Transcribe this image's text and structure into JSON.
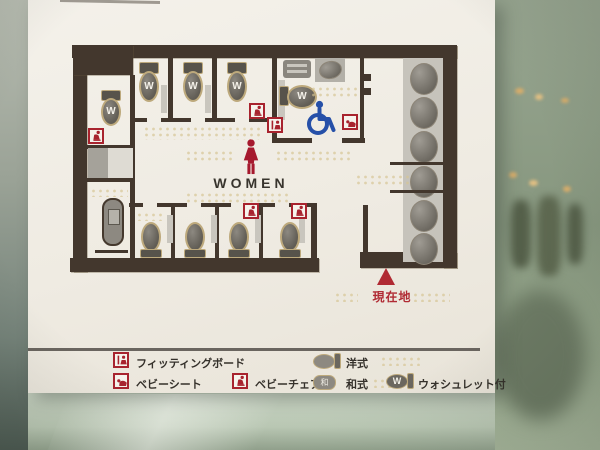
{
  "sign": {
    "type": "restroom-floor-plan",
    "title": "WOMEN",
    "current_location_label": "現在地",
    "washlet_letter": "W",
    "squat_mark": "和",
    "legend": {
      "items": [
        {
          "icon": "fitting-board-icon",
          "label": "フィッティングボード"
        },
        {
          "icon": "baby-sheet-icon",
          "label": "ベビーシート"
        },
        {
          "icon": "baby-chair-icon",
          "label": "ベビーチェア"
        },
        {
          "icon": "western-toilet-icon",
          "label": "洋式"
        },
        {
          "icon": "squat-toilet-icon",
          "label": "和式"
        },
        {
          "icon": "washlet-toilet-icon",
          "label": "ウォシュレット付"
        }
      ]
    },
    "fixtures": {
      "washlet_western_toilets": 5,
      "plain_western_toilets": 4,
      "squat_toilets": 1,
      "sink_basins": 6,
      "accessible_stall": true,
      "baby_chairs": 4,
      "baby_sheets": 1,
      "fitting_boards": 1
    }
  },
  "colors": {
    "wall_brown": "#43372d",
    "sign_white": "#efebe2",
    "accent_red": "#a8232e",
    "wheelchair_blue": "#2650a8",
    "fixture_gray": "#6b675f",
    "counter_gray": "#c6c3bb",
    "background_glass_green": "#8fa08a",
    "braille_gold": "#d6c492"
  }
}
